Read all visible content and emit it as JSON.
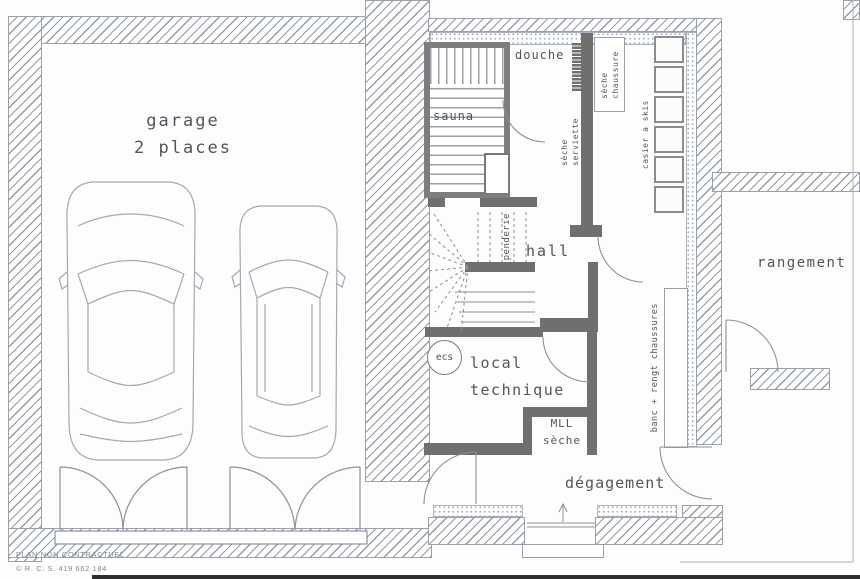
{
  "plan": {
    "rooms": {
      "garage": {
        "line1": "garage",
        "line2": "2 places"
      },
      "sauna": "sauna",
      "douche": "douche",
      "hall": "hall",
      "local_technique": {
        "line1": "local",
        "line2": "technique"
      },
      "degagement": "dégagement",
      "rangement": "rangement"
    },
    "fixtures": {
      "seche_chaussure": {
        "line1": "sèche",
        "line2": "chaussure"
      },
      "seche_serviette": {
        "line1": "sèche",
        "line2": "serviette"
      },
      "casier_skis": "casier a skis",
      "penderie": "penderie",
      "ecs": "ecs",
      "mll": {
        "line1": "MLL",
        "line2": "sèche"
      },
      "banc": "banc + rengt chaussures"
    },
    "footer": {
      "line1": "PLAN NON CONTRACTUEL",
      "line2": "© R. C. S. 419 662 184"
    },
    "colors": {
      "wall_hatch": "#8d939c",
      "partition": "#6f6f6f",
      "line": "#8b919a",
      "text": "#50565d",
      "footer_text": "#7e8c8b"
    }
  }
}
